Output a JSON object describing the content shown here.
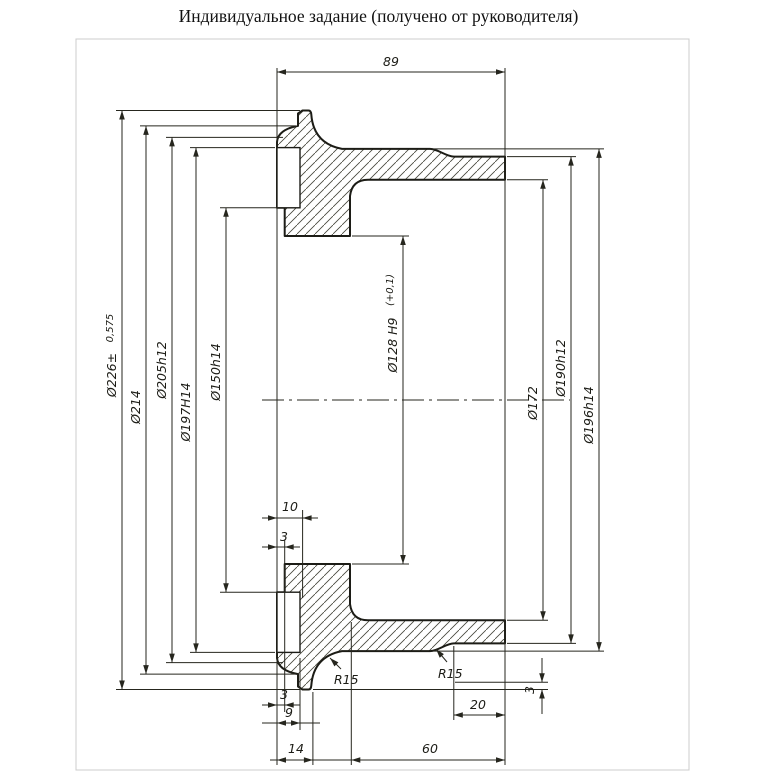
{
  "title": "Индивидуальное задание (получено от руководителя)",
  "colors": {
    "line": "#1c1c16",
    "thin_line": "#26261e",
    "hatch": "#45453a",
    "frame": "#cccccc",
    "background": "#ffffff"
  },
  "drawing": {
    "type": "section-view-brake-drum",
    "dims": {
      "d226": {
        "label": "Ø226±",
        "tol": "0,575"
      },
      "d214": {
        "label": "Ø214"
      },
      "d205": {
        "label": "Ø205h12"
      },
      "d197": {
        "label": "Ø197H14"
      },
      "d150": {
        "label": "Ø150h14"
      },
      "d128": {
        "label": "Ø128 H9",
        "tol": "(+0,1)"
      },
      "d172": {
        "label": "Ø172"
      },
      "d190": {
        "label": "Ø190h12"
      },
      "d196": {
        "label": "Ø196h14"
      },
      "len89": {
        "label": "89"
      },
      "len10": {
        "label": "10"
      },
      "len3_recess": {
        "label": "3"
      },
      "len3_bottom": {
        "label": "3"
      },
      "len9": {
        "label": "9"
      },
      "len14": {
        "label": "14"
      },
      "len60": {
        "label": "60"
      },
      "len20": {
        "label": "20"
      },
      "len3_right": {
        "label": "3"
      },
      "r15_left": {
        "label": "R15"
      },
      "r15_right": {
        "label": "R15"
      }
    }
  }
}
